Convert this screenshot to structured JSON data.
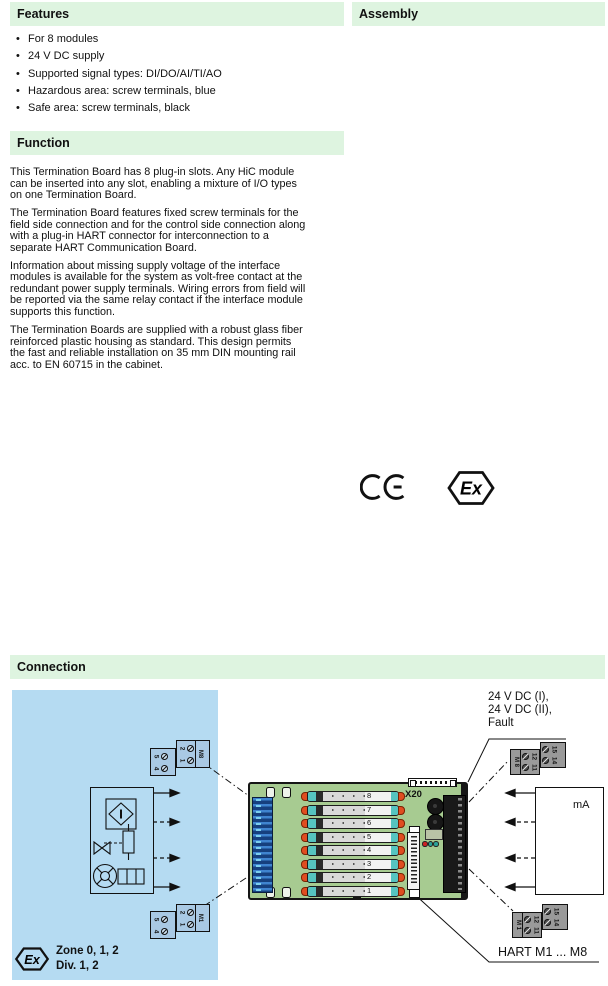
{
  "colors": {
    "section_bar_bg": "#def4e0",
    "hazardous_area_bg": "#b5dbf2",
    "board_green": "#a7cb91",
    "field_terminal_blue": "#16407e",
    "slot_teal": "#56c4c0",
    "slot_clip_red": "#e04d20",
    "control_block_gray": "#9a9a9a"
  },
  "sections": {
    "features": {
      "title": "Features",
      "items": [
        "For 8 modules",
        "24 V DC supply",
        "Supported signal types: DI/DO/AI/TI/AO",
        "Hazardous area: screw terminals, blue",
        "Safe area: screw terminals, black"
      ]
    },
    "assembly": {
      "title": "Assembly"
    },
    "function": {
      "title": "Function",
      "paragraphs": [
        "This Termination Board has 8 plug-in slots. Any HiC module\ncan be inserted into any slot, enabling a mixture of I/O types\non one Termination Board.",
        "The Termination Board features fixed screw terminals for the\nfield side connection and for the control side connection along\nwith a plug-in HART connector for interconnection to a\nseparate HART Communication Board.",
        "Information about missing supply voltage of the interface\nmodules is available for the system as volt-free contact at the\nredundant power supply terminals. Wiring errors from field will\nbe reported via the same relay contact if the interface module\nsupports this function.",
        "The Termination Boards are supplied with a robust glass fiber\nreinforced plastic housing as standard. This design permits\nthe fast and reliable installation on 35 mm DIN mounting rail\nacc. to EN 60715 in the cabinet."
      ]
    },
    "connection": {
      "title": "Connection"
    }
  },
  "marks": {
    "ce_label": "CE",
    "ex_label": "Ex"
  },
  "diagram": {
    "power_labels": [
      "24 V DC (I),",
      "24 V DC (II),",
      "Fault"
    ],
    "hart_label": "HART M1 ... M8",
    "x20_label": "X20",
    "ma_label": "mA",
    "zone_label": "Zone 0, 1, 2",
    "div_label": "Div. 1, 2",
    "slot_numbers": [
      "8",
      "7",
      "6",
      "5",
      "4",
      "3",
      "2",
      "1"
    ],
    "field_block_top": {
      "module": "M8",
      "left_terminals": [
        "5",
        "4"
      ],
      "right_terminals": [
        "2",
        "1"
      ]
    },
    "field_block_bottom": {
      "module": "M1",
      "left_terminals": [
        "5",
        "4"
      ],
      "right_terminals": [
        "2",
        "1"
      ]
    },
    "control_block_top": {
      "module": "M 8",
      "signal_terminals": [
        "12",
        "11"
      ],
      "power_terminals": [
        "15",
        "14"
      ]
    },
    "control_block_bottom": {
      "module": "M 1",
      "signal_terminals": [
        "12",
        "11"
      ],
      "power_terminals": [
        "15",
        "14"
      ]
    }
  }
}
